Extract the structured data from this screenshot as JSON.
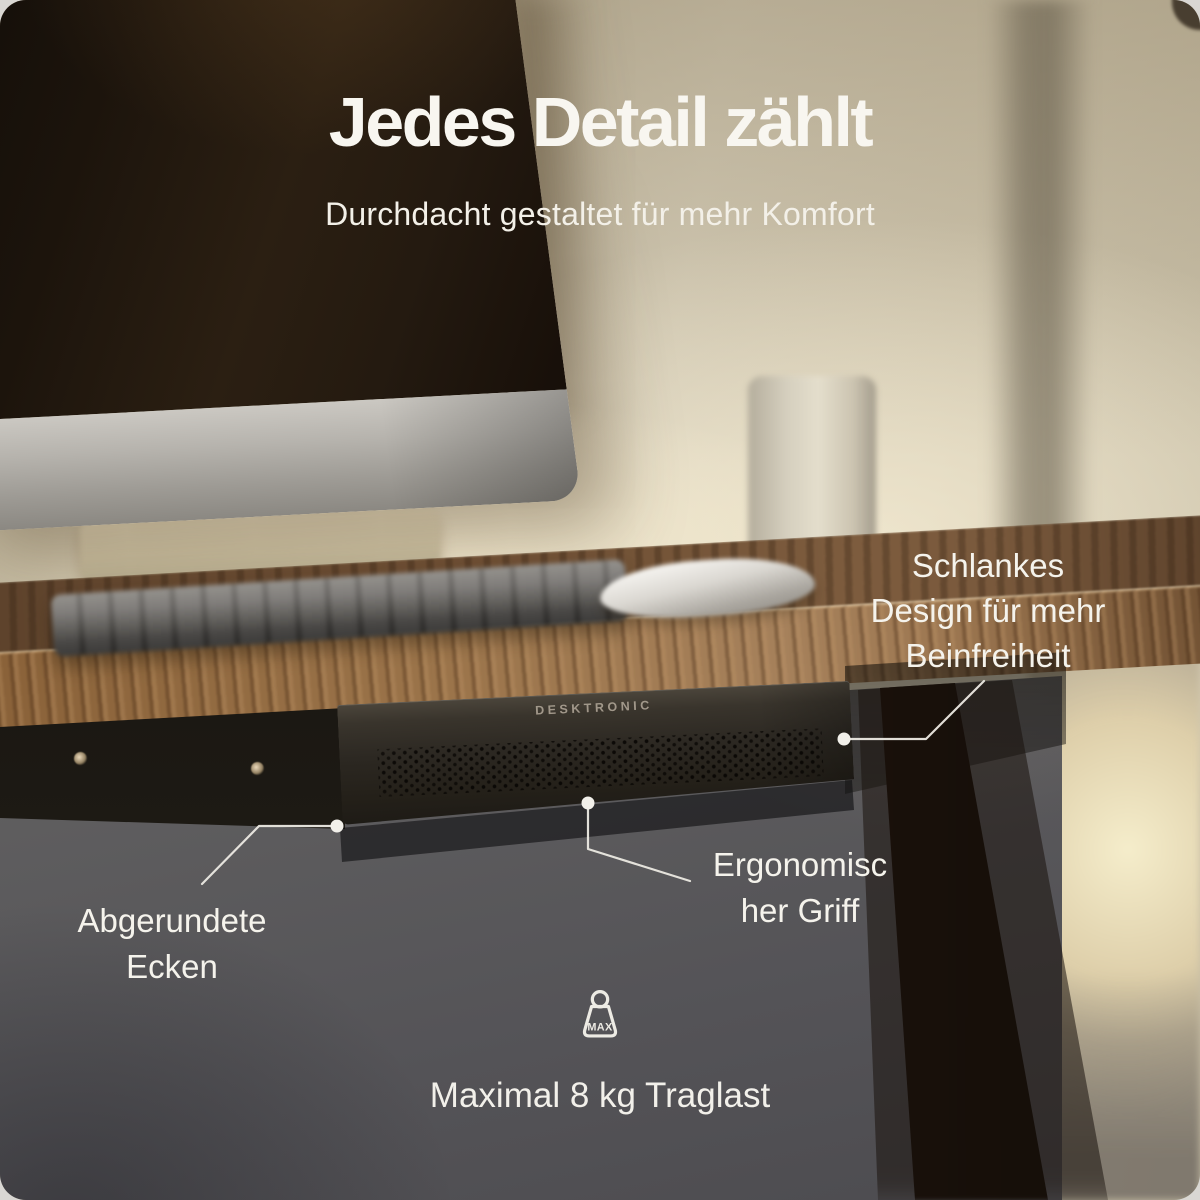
{
  "header": {
    "title": "Jedes Detail zählt",
    "subtitle": "Durchdacht gestaltet für mehr Komfort"
  },
  "product": {
    "brand": "DESKTRONIC"
  },
  "callouts": {
    "slim_design": {
      "label": "Schlankes Design für mehr Beinfreiheit",
      "lines": [
        "Schlankes",
        "Design für mehr",
        "Beinfreiheit"
      ]
    },
    "rounded_corners": {
      "label": "Abgerundete Ecken",
      "lines": [
        "Abgerundete",
        "Ecken"
      ]
    },
    "ergonomic_handle": {
      "label": "Ergonomischer Griff",
      "lines": [
        "Ergonomisc",
        "her Griff"
      ]
    },
    "max_load": {
      "label": "Maximal 8 kg Traglast",
      "badge": "MAX",
      "icon": "weight-max-icon"
    }
  },
  "colors": {
    "text": "#f5f3ec",
    "callout_line": "#eceae3",
    "wood": "#7a5636",
    "drawer": "#2b2620",
    "under_desk_gray": "#5f5e5f",
    "wall_beige": "#d2c9b2",
    "glow": "#f5edcb"
  }
}
